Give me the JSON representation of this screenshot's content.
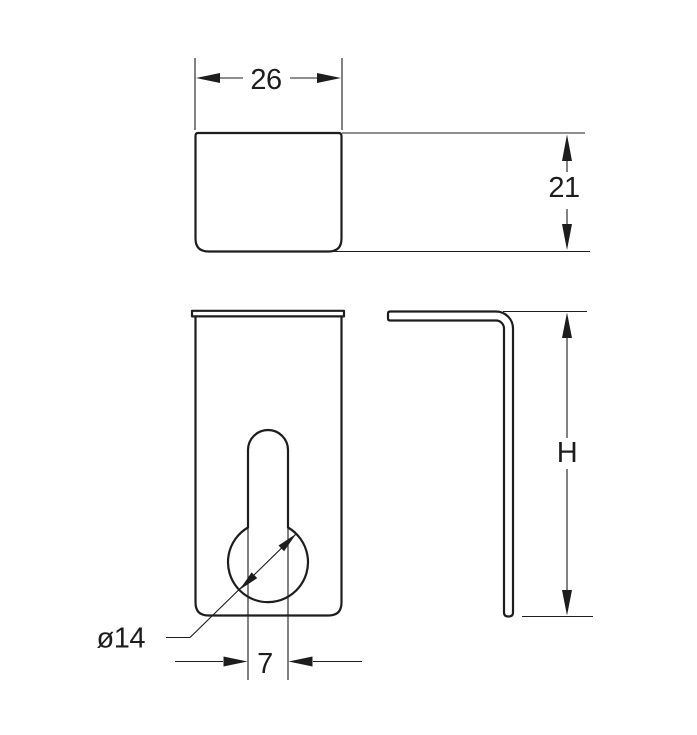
{
  "drawing": {
    "background_color": "#ffffff",
    "line_color": "#1d1d1d",
    "views": {
      "top": {
        "width_label": "26",
        "depth_label": "21"
      },
      "front": {
        "hole_diameter_label": "ø14",
        "slot_width_label": "7"
      },
      "side": {
        "height_label": "H"
      }
    }
  }
}
